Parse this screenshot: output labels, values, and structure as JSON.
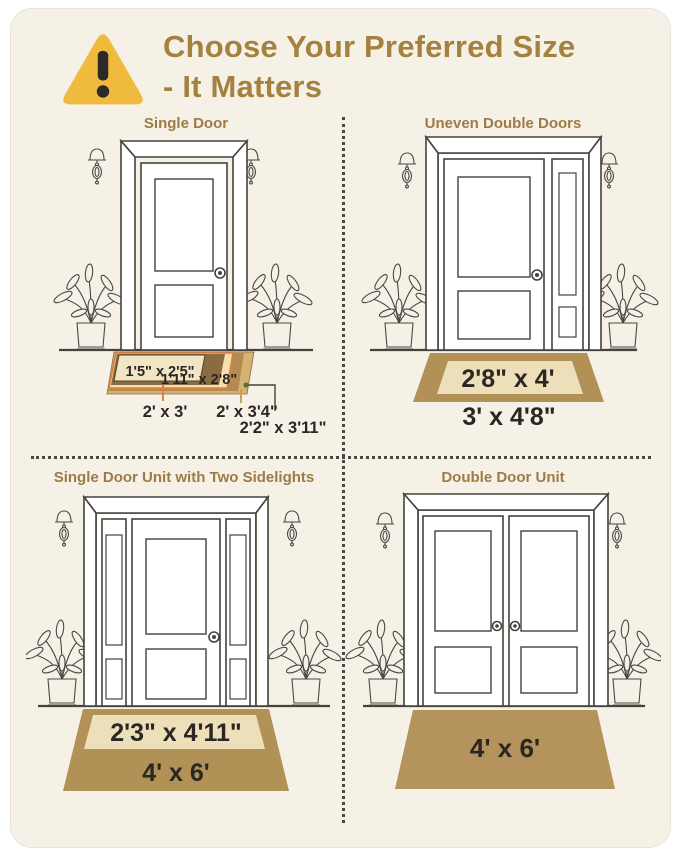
{
  "header": {
    "title_line1": "Choose Your Preferred Size",
    "title_line2": "- It Matters"
  },
  "quadrants": {
    "single_door": {
      "title": "Single Door",
      "mats": {
        "size1": "1'5\" x 2'5\"",
        "size2": "1'11\" x 2'8\"",
        "size3": "2' x 3'",
        "size4": "2' x 3'4\"",
        "size5": "2'2\" x 3'11\""
      }
    },
    "uneven_double": {
      "title": "Uneven Double Doors",
      "inner_size": "2'8\" x 4'",
      "outer_size": "3' x 4'8\""
    },
    "sidelights": {
      "title": "Single Door Unit with Two Sidelights",
      "inner_size": "2'3\" x 4'11\"",
      "outer_size": "4' x 6'"
    },
    "double_door": {
      "title": "Double Door Unit",
      "size": "4' x 6'"
    }
  },
  "colors": {
    "card_bg": "#f6f1e7",
    "accent_gold": "#a5813e",
    "warning_yellow": "#efba3e",
    "mat_tan": "#b29157",
    "mat_cream": "#ecdfba",
    "mat_dark_band": "#8a6c42",
    "mat_peach": "#f6dfae",
    "mat_orange_edge": "#e0823d",
    "mat_mid_brown": "#b28a52",
    "mat_outer_tan": "#d3b273",
    "green_dot": "#5f6f3a"
  }
}
